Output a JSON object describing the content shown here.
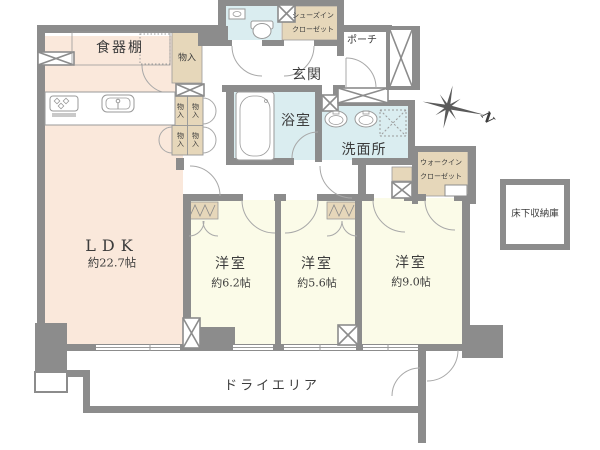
{
  "colors": {
    "wall": "#8c8c8c",
    "ldk": "#fae8db",
    "bedroom": "#fbfbe8",
    "wet": "#daedf0",
    "closet": "#e6d7ba",
    "line": "#9a9a9a",
    "text": "#3c3c3c"
  },
  "labels": {
    "ldk": {
      "name": "LDK",
      "area": "約22.7帖"
    },
    "bedroom_62": {
      "name": "洋室",
      "area": "約6.2帖"
    },
    "bedroom_56": {
      "name": "洋室",
      "area": "約5.6帖"
    },
    "bedroom_90": {
      "name": "洋室",
      "area": "約9.0帖"
    },
    "bathroom": "浴室",
    "washroom": "洗面所",
    "entrance": "玄関",
    "porch": "ポーチ",
    "cupboard": "食器棚",
    "storage": "物入",
    "storage_cells": [
      "物入",
      "物入",
      "物入",
      "物入"
    ],
    "shoe_closet": [
      "シューズイン",
      "クローゼット"
    ],
    "walk_in_closet": [
      "ウォークイン",
      "クローゼット"
    ],
    "underfloor_storage": "床下収納庫",
    "dry_area": "ドライエリア",
    "compass_north": "N"
  }
}
